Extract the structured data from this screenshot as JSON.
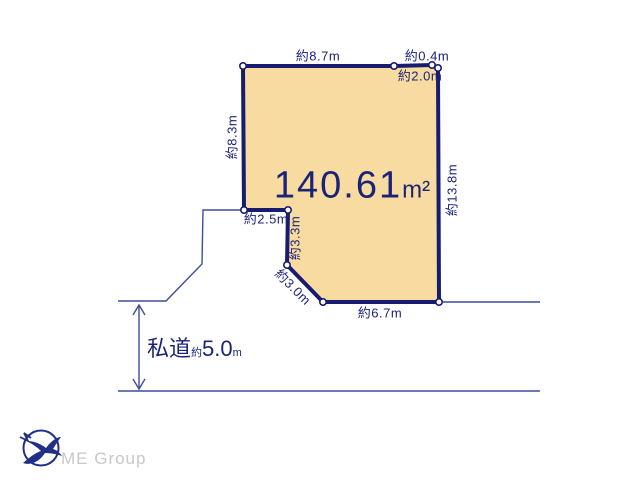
{
  "diagram": {
    "area": {
      "value": "140.61",
      "unit": "m²"
    },
    "measurements": {
      "top": "約8.7m",
      "top_right_corner": "約0.4m",
      "top_right": "約2.0m",
      "left": "約8.3m",
      "right": "約13.8m",
      "step": "約2.5m",
      "inner_vertical": "約3.3m",
      "diagonal": "約3.0m",
      "bottom": "約6.7m"
    },
    "road": {
      "name": "私道",
      "approx": "約",
      "value": "5.0",
      "unit": "m"
    },
    "colors": {
      "plot_fill": "#F8DBA0",
      "plot_border": "#171C70",
      "label_text": "#1B2377",
      "road_line": "#3F4C9A",
      "logo": "#203087",
      "logo_text": "#C8C8C8"
    }
  },
  "footer": {
    "logo_text": "ME Group"
  }
}
